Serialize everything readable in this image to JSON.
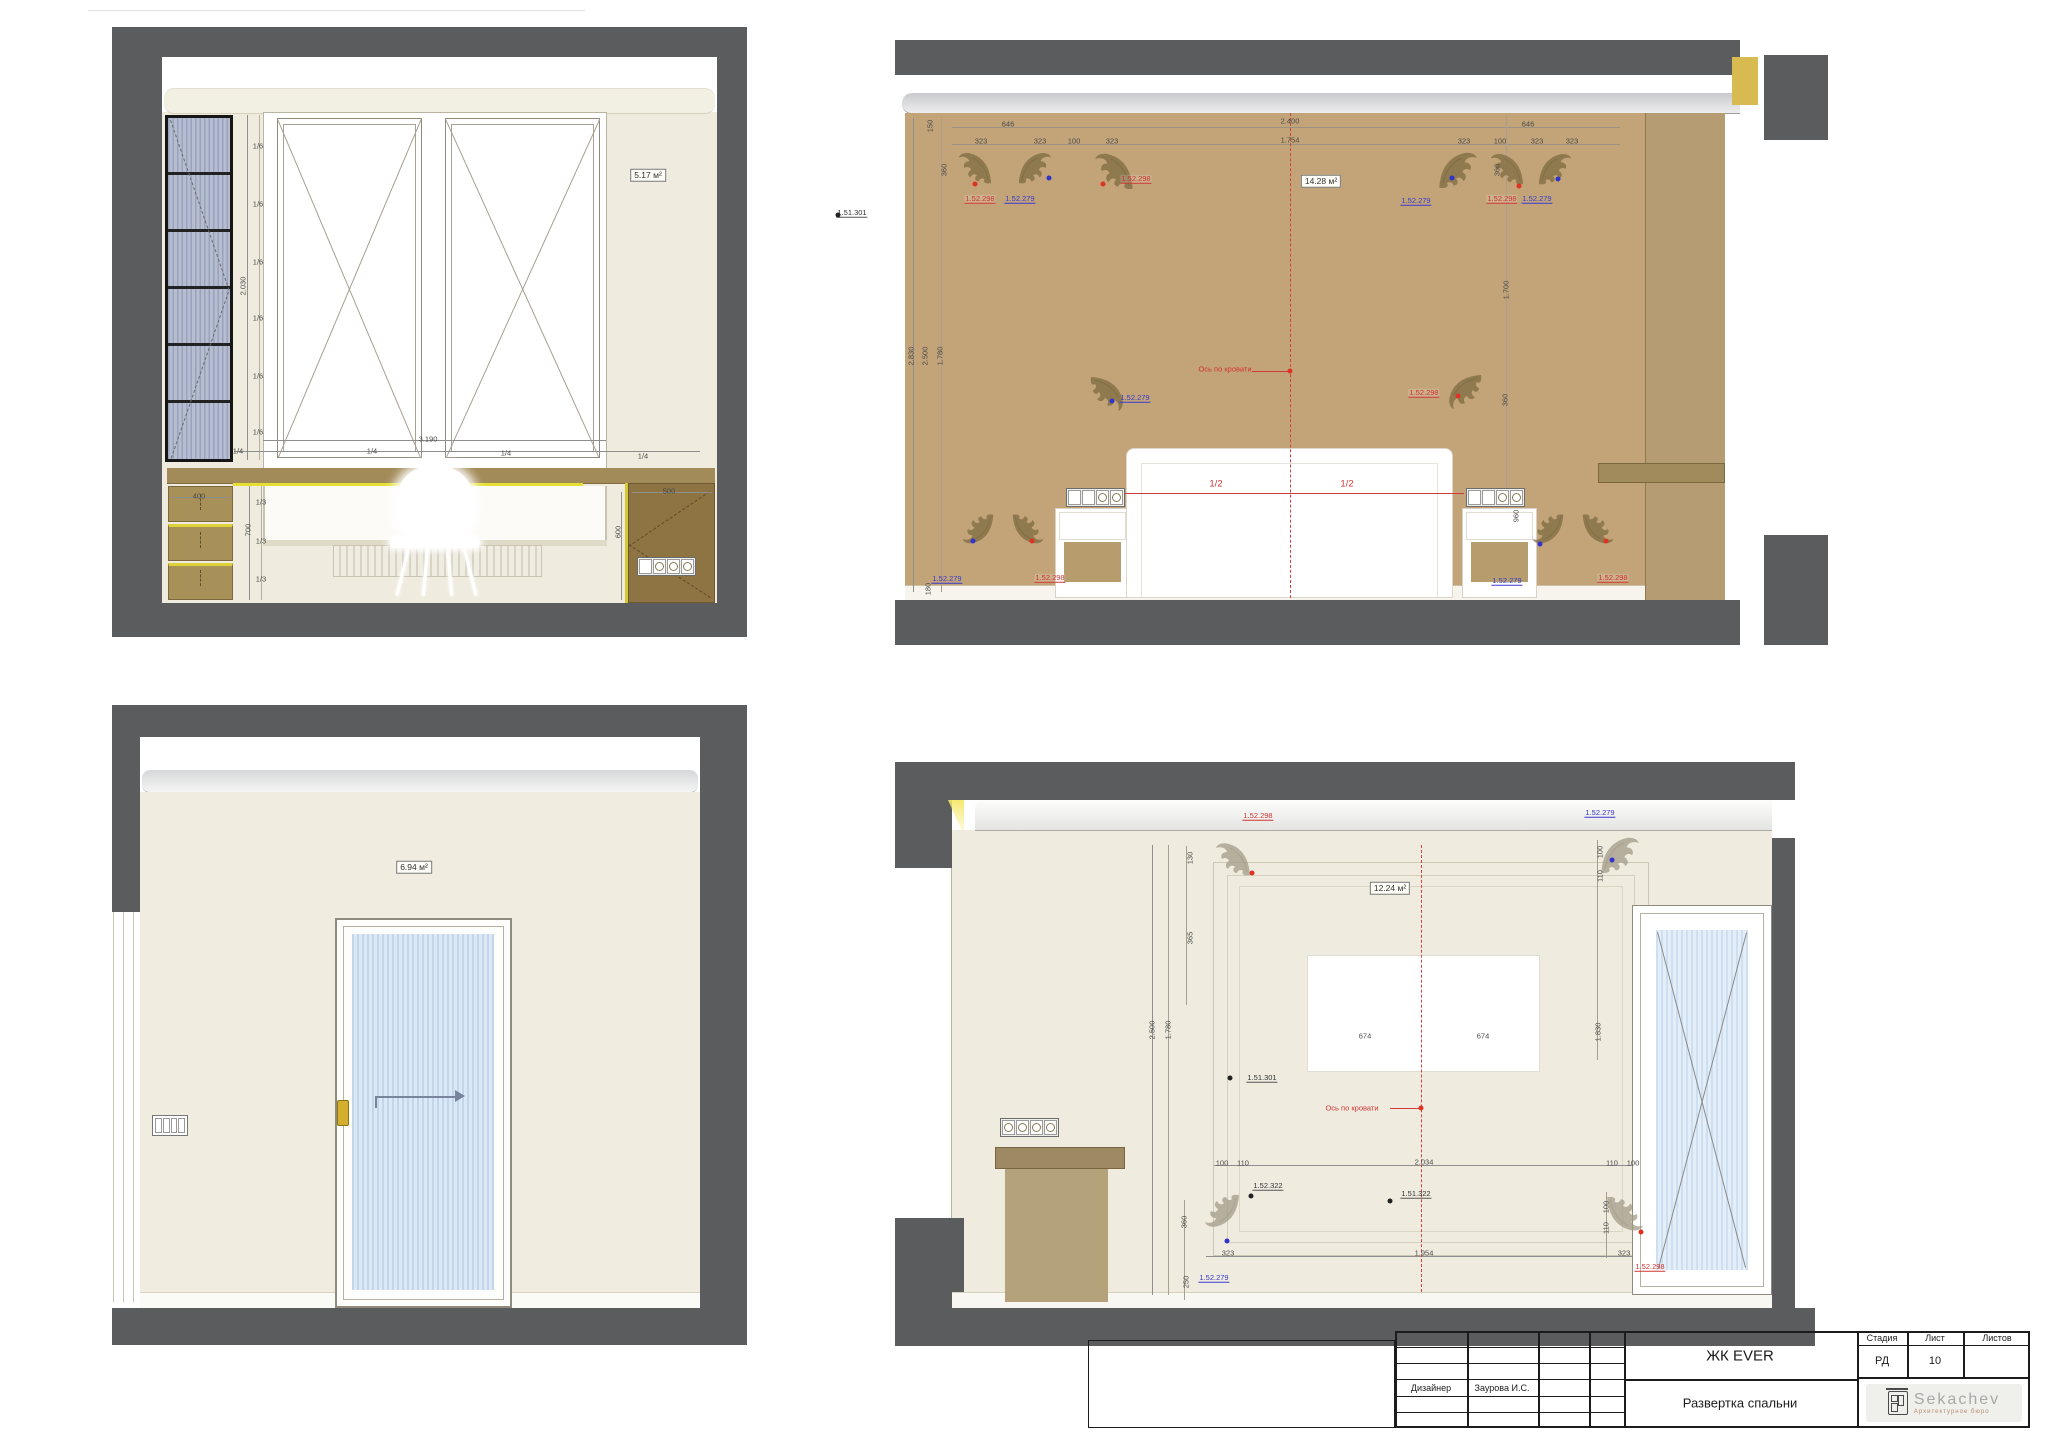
{
  "titleblock": {
    "project": "ЖК EVER",
    "drawing_title": "Развертка спальни",
    "stage_label": "Стадия",
    "stage": "РД",
    "sheet_label": "Лист",
    "sheet_no": "10",
    "sheets_label": "Листов",
    "designer_label": "Дизайнер",
    "designer_name": "Заурова И.С.",
    "logo_text": "Sekachev",
    "logo_sub": "Архитектурное бюро"
  },
  "icons": {
    "ornament-icon": "floral-corner-moulding",
    "socket-icon": "round-outlet-group",
    "switch-icon": "rocker-switch-panel"
  },
  "annotations": [
    {
      "t": "2.030",
      "x": 243,
      "y": 286,
      "c": "dim",
      "r": 1
    },
    {
      "t": "1/6",
      "x": 258,
      "y": 146,
      "c": "dim"
    },
    {
      "t": "1/6",
      "x": 258,
      "y": 204,
      "c": "dim"
    },
    {
      "t": "1/6",
      "x": 258,
      "y": 262,
      "c": "dim"
    },
    {
      "t": "1/6",
      "x": 258,
      "y": 318,
      "c": "dim"
    },
    {
      "t": "1/6",
      "x": 258,
      "y": 376,
      "c": "dim"
    },
    {
      "t": "1/6",
      "x": 258,
      "y": 432,
      "c": "dim"
    },
    {
      "t": "3.190",
      "x": 428,
      "y": 439,
      "c": "dim"
    },
    {
      "t": "1/4",
      "x": 238,
      "y": 451,
      "c": "dim"
    },
    {
      "t": "1/4",
      "x": 372,
      "y": 451,
      "c": "dim"
    },
    {
      "t": "1/4",
      "x": 506,
      "y": 453,
      "c": "dim"
    },
    {
      "t": "1/4",
      "x": 643,
      "y": 456,
      "c": "dim"
    },
    {
      "t": "400",
      "x": 199,
      "y": 496,
      "c": "dim"
    },
    {
      "t": "700",
      "x": 248,
      "y": 530,
      "c": "dim",
      "r": 1
    },
    {
      "t": "1/3",
      "x": 261,
      "y": 502,
      "c": "dim"
    },
    {
      "t": "1/3",
      "x": 261,
      "y": 541,
      "c": "dim"
    },
    {
      "t": "1/3",
      "x": 261,
      "y": 579,
      "c": "dim"
    },
    {
      "t": "500",
      "x": 669,
      "y": 491,
      "c": "dim"
    },
    {
      "t": "600",
      "x": 618,
      "y": 532,
      "c": "dim",
      "r": 1
    },
    {
      "t": "5.17 м²",
      "x": 648,
      "y": 175,
      "c": "area"
    },
    {
      "t": "646",
      "x": 1008,
      "y": 124,
      "c": "dim"
    },
    {
      "t": "2.400",
      "x": 1290,
      "y": 121,
      "c": "dim"
    },
    {
      "t": "646",
      "x": 1528,
      "y": 124,
      "c": "dim"
    },
    {
      "t": "323",
      "x": 981,
      "y": 141,
      "c": "dim"
    },
    {
      "t": "323",
      "x": 1040,
      "y": 141,
      "c": "dim"
    },
    {
      "t": "100",
      "x": 1074,
      "y": 141,
      "c": "dim"
    },
    {
      "t": "323",
      "x": 1112,
      "y": 141,
      "c": "dim"
    },
    {
      "t": "1.754",
      "x": 1290,
      "y": 140,
      "c": "dim"
    },
    {
      "t": "323",
      "x": 1464,
      "y": 141,
      "c": "dim"
    },
    {
      "t": "100",
      "x": 1500,
      "y": 141,
      "c": "dim"
    },
    {
      "t": "323",
      "x": 1537,
      "y": 141,
      "c": "dim"
    },
    {
      "t": "323",
      "x": 1572,
      "y": 141,
      "c": "dim"
    },
    {
      "t": "150",
      "x": 930,
      "y": 126,
      "c": "dim",
      "r": 1
    },
    {
      "t": "360",
      "x": 944,
      "y": 170,
      "c": "dim",
      "r": 1
    },
    {
      "t": "2.830",
      "x": 911,
      "y": 356,
      "c": "dim",
      "r": 1
    },
    {
      "t": "2.500",
      "x": 925,
      "y": 356,
      "c": "dim",
      "r": 1
    },
    {
      "t": "1.780",
      "x": 940,
      "y": 356,
      "c": "dim",
      "r": 1
    },
    {
      "t": "180",
      "x": 928,
      "y": 589,
      "c": "dim",
      "r": 1
    },
    {
      "t": "360",
      "x": 1497,
      "y": 170,
      "c": "dim",
      "r": 1
    },
    {
      "t": "1.700",
      "x": 1506,
      "y": 290,
      "c": "dim",
      "r": 1
    },
    {
      "t": "360",
      "x": 1505,
      "y": 400,
      "c": "dim",
      "r": 1
    },
    {
      "t": "960",
      "x": 1516,
      "y": 516,
      "c": "dim",
      "r": 1
    },
    {
      "t": "1.52.298",
      "x": 980,
      "y": 199,
      "c": "refr"
    },
    {
      "t": "1.52.279",
      "x": 1020,
      "y": 199,
      "c": "refb"
    },
    {
      "t": "1.52.298",
      "x": 1136,
      "y": 179,
      "c": "refr"
    },
    {
      "t": "1.52.279",
      "x": 1416,
      "y": 201,
      "c": "refb"
    },
    {
      "t": "1.52.298",
      "x": 1502,
      "y": 199,
      "c": "refr"
    },
    {
      "t": "1.52.279",
      "x": 1537,
      "y": 199,
      "c": "refb"
    },
    {
      "t": "1.52.279",
      "x": 1135,
      "y": 398,
      "c": "refb"
    },
    {
      "t": "1.52.298",
      "x": 1424,
      "y": 393,
      "c": "refr"
    },
    {
      "t": "1.52.279",
      "x": 947,
      "y": 579,
      "c": "refb"
    },
    {
      "t": "1.52.298",
      "x": 1050,
      "y": 578,
      "c": "refr"
    },
    {
      "t": "1.52.279",
      "x": 1507,
      "y": 581,
      "c": "refb"
    },
    {
      "t": "1.52.298",
      "x": 1613,
      "y": 578,
      "c": "refr"
    },
    {
      "t": "1.51.301",
      "x": 852,
      "y": 213,
      "c": "refk"
    },
    {
      "t": "Ось по кровати",
      "x": 1225,
      "y": 369,
      "c": "axis"
    },
    {
      "t": "1/2",
      "x": 1216,
      "y": 484,
      "c": "half"
    },
    {
      "t": "1/2",
      "x": 1347,
      "y": 484,
      "c": "half"
    },
    {
      "t": "14.28 м²",
      "x": 1321,
      "y": 181,
      "c": "area"
    },
    {
      "t": "",
      "x": 975,
      "y": 184,
      "c": "dotr"
    },
    {
      "t": "",
      "x": 1049,
      "y": 178,
      "c": "dotb"
    },
    {
      "t": "",
      "x": 1103,
      "y": 184,
      "c": "dotr"
    },
    {
      "t": "",
      "x": 1452,
      "y": 178,
      "c": "dotb"
    },
    {
      "t": "",
      "x": 1519,
      "y": 186,
      "c": "dotr"
    },
    {
      "t": "",
      "x": 1558,
      "y": 179,
      "c": "dotb"
    },
    {
      "t": "",
      "x": 1112,
      "y": 401,
      "c": "dotb"
    },
    {
      "t": "",
      "x": 1458,
      "y": 396,
      "c": "dotr"
    },
    {
      "t": "",
      "x": 973,
      "y": 541,
      "c": "dotb"
    },
    {
      "t": "",
      "x": 1032,
      "y": 541,
      "c": "dotr"
    },
    {
      "t": "",
      "x": 1540,
      "y": 544,
      "c": "dotb"
    },
    {
      "t": "",
      "x": 1606,
      "y": 541,
      "c": "dotr"
    },
    {
      "t": "",
      "x": 838,
      "y": 215,
      "c": "dotk"
    },
    {
      "t": "",
      "x": 1290,
      "y": 371,
      "c": "dotr"
    },
    {
      "t": "6.94 м²",
      "x": 414,
      "y": 867,
      "c": "area"
    },
    {
      "t": "130",
      "x": 1190,
      "y": 858,
      "c": "dim",
      "r": 1
    },
    {
      "t": "365",
      "x": 1190,
      "y": 938,
      "c": "dim",
      "r": 1
    },
    {
      "t": "1.52.298",
      "x": 1258,
      "y": 816,
      "c": "refr"
    },
    {
      "t": "1.52.279",
      "x": 1600,
      "y": 813,
      "c": "refb"
    },
    {
      "t": "12.24 м²",
      "x": 1390,
      "y": 888,
      "c": "area"
    },
    {
      "t": "2.500",
      "x": 1152,
      "y": 1030,
      "c": "dim",
      "r": 1
    },
    {
      "t": "1.780",
      "x": 1168,
      "y": 1030,
      "c": "dim",
      "r": 1
    },
    {
      "t": "674",
      "x": 1365,
      "y": 1036,
      "c": "dim"
    },
    {
      "t": "674",
      "x": 1483,
      "y": 1036,
      "c": "dim"
    },
    {
      "t": "1.51.301",
      "x": 1262,
      "y": 1078,
      "c": "refk"
    },
    {
      "t": "Ось по кровати",
      "x": 1352,
      "y": 1108,
      "c": "axis"
    },
    {
      "t": "100",
      "x": 1222,
      "y": 1163,
      "c": "dim"
    },
    {
      "t": "110",
      "x": 1243,
      "y": 1163,
      "c": "dim"
    },
    {
      "t": "2.034",
      "x": 1424,
      "y": 1162,
      "c": "dim"
    },
    {
      "t": "110",
      "x": 1612,
      "y": 1163,
      "c": "dim"
    },
    {
      "t": "100",
      "x": 1633,
      "y": 1163,
      "c": "dim"
    },
    {
      "t": "1.52.322",
      "x": 1268,
      "y": 1186,
      "c": "refk"
    },
    {
      "t": "1.51.322",
      "x": 1416,
      "y": 1194,
      "c": "refk"
    },
    {
      "t": "323",
      "x": 1228,
      "y": 1253,
      "c": "dim"
    },
    {
      "t": "1.954",
      "x": 1424,
      "y": 1253,
      "c": "dim"
    },
    {
      "t": "323",
      "x": 1624,
      "y": 1253,
      "c": "dim"
    },
    {
      "t": "1.52.279",
      "x": 1214,
      "y": 1278,
      "c": "refb"
    },
    {
      "t": "1.52.298",
      "x": 1650,
      "y": 1267,
      "c": "refr"
    },
    {
      "t": "100",
      "x": 1600,
      "y": 852,
      "c": "dim",
      "r": 1
    },
    {
      "t": "110",
      "x": 1600,
      "y": 876,
      "c": "dim",
      "r": 1
    },
    {
      "t": "1.830",
      "x": 1598,
      "y": 1032,
      "c": "dim",
      "r": 1
    },
    {
      "t": "100",
      "x": 1606,
      "y": 1207,
      "c": "dim",
      "r": 1
    },
    {
      "t": "110",
      "x": 1606,
      "y": 1228,
      "c": "dim",
      "r": 1
    },
    {
      "t": "360",
      "x": 1184,
      "y": 1222,
      "c": "dim",
      "r": 1
    },
    {
      "t": "250",
      "x": 1186,
      "y": 1282,
      "c": "dim",
      "r": 1
    },
    {
      "t": "",
      "x": 1252,
      "y": 873,
      "c": "dotr"
    },
    {
      "t": "",
      "x": 1612,
      "y": 860,
      "c": "dotb"
    },
    {
      "t": "",
      "x": 1227,
      "y": 1241,
      "c": "dotb"
    },
    {
      "t": "",
      "x": 1641,
      "y": 1232,
      "c": "dotr"
    },
    {
      "t": "",
      "x": 1251,
      "y": 1196,
      "c": "dotk"
    },
    {
      "t": "",
      "x": 1390,
      "y": 1201,
      "c": "dotk"
    },
    {
      "t": "",
      "x": 1230,
      "y": 1078,
      "c": "dotk"
    },
    {
      "t": "",
      "x": 1421,
      "y": 1108,
      "c": "dotr"
    }
  ]
}
